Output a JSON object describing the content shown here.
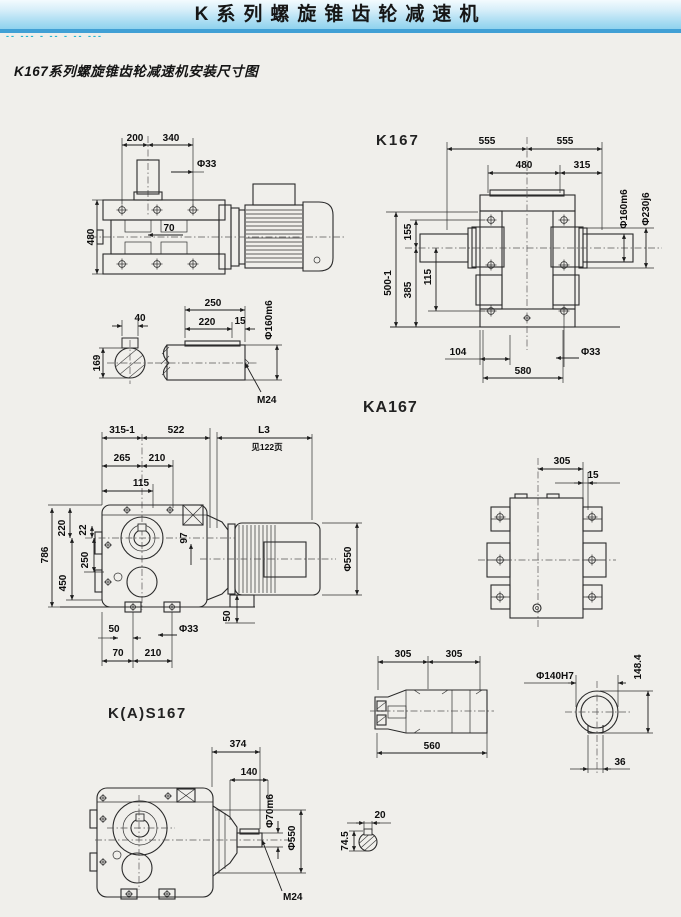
{
  "header": {
    "title": "K系列螺旋锥齿轮减速机"
  },
  "watermark": "-- --- - -- - -- ---",
  "subtitle": "K167系列螺旋锥齿轮减速机安装尺寸图",
  "models": {
    "k167": "K167",
    "ka167": "KA167",
    "kas167": "K(A)S167"
  },
  "side_view": {
    "w200": "200",
    "w340": "340",
    "dia33": "Φ33",
    "w70": "70",
    "h480": "480"
  },
  "shaft_detail": {
    "kw40": "40",
    "h169": "169",
    "w250": "250",
    "w220": "220",
    "w15": "15",
    "dia160": "Φ160m6",
    "thread": "M24"
  },
  "front_view": {
    "w555l": "555",
    "w555r": "555",
    "w480": "480",
    "w315": "315",
    "dia160": "Φ160m6",
    "dia230": "Φ230j6",
    "h155": "155",
    "h385": "385",
    "h115": "115",
    "h500": "500-1",
    "w104": "104",
    "w580": "580",
    "dia33": "Φ33"
  },
  "ka_view": {
    "w315_1": "315-1",
    "w522": "522",
    "l3": "L3",
    "l3_note": "见122页",
    "w265": "265",
    "w210": "210",
    "w115": "115",
    "h220": "220",
    "h22": "22",
    "h97": "97",
    "h786": "786",
    "h450": "450",
    "h250": "250",
    "dia550": "Φ550",
    "w50": "50",
    "dia33": "Φ33",
    "w70": "70",
    "w210b": "210",
    "h50": "50"
  },
  "top_view": {
    "w305": "305",
    "w15": "15"
  },
  "hollow_shaft": {
    "w305a": "305",
    "w305b": "305",
    "w560": "560"
  },
  "bore_detail": {
    "dia140": "Φ140H7",
    "h148": "148.4",
    "w36": "36"
  },
  "kas_view": {
    "w374": "374",
    "w140": "140",
    "dia70": "Φ70m6",
    "dia550": "Φ550",
    "thread": "M24"
  },
  "key_section": {
    "w20": "20",
    "h74": "74.5"
  }
}
